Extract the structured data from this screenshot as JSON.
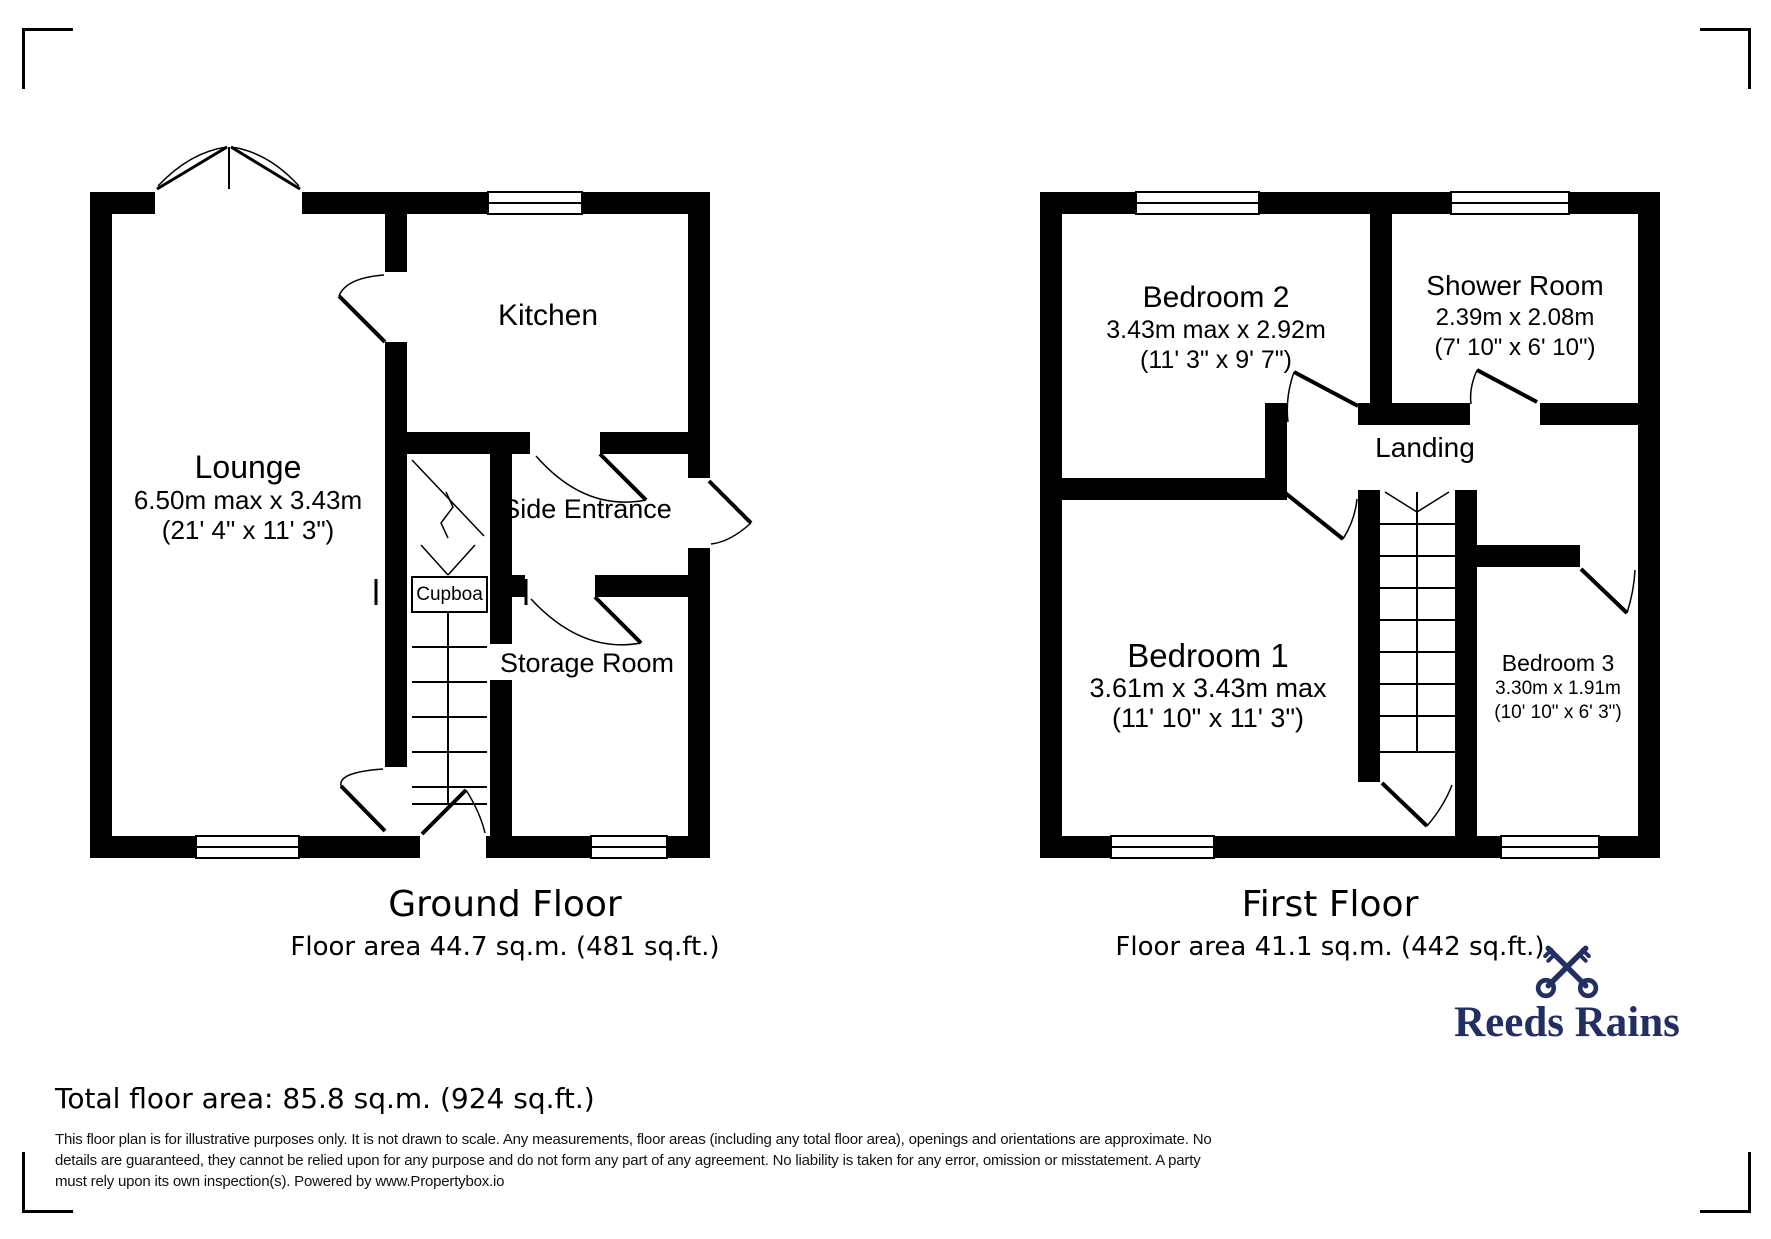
{
  "branding": {
    "logo_text": "Reeds Rains",
    "logo_color": "#212f63"
  },
  "ground_floor": {
    "title": "Ground Floor",
    "floor_area": "Floor area 44.7 sq.m. (481 sq.ft.)",
    "rooms": {
      "lounge": {
        "name": "Lounge",
        "dim_metric": "6.50m max x 3.43m",
        "dim_imperial": "(21' 4\" x 11' 3\")"
      },
      "kitchen": {
        "name": "Kitchen"
      },
      "side_entrance": {
        "name": "Side Entrance"
      },
      "storage_room": {
        "name": "Storage Room"
      },
      "cupboard": {
        "name": "Cupboa"
      }
    }
  },
  "first_floor": {
    "title": "First Floor",
    "floor_area": "Floor area 41.1 sq.m. (442 sq.ft.)",
    "rooms": {
      "bedroom_1": {
        "name": "Bedroom 1",
        "dim_metric": "3.61m x 3.43m max",
        "dim_imperial": "(11' 10\" x 11' 3\")"
      },
      "bedroom_2": {
        "name": "Bedroom 2",
        "dim_metric": "3.43m max x 2.92m",
        "dim_imperial": "(11' 3\" x 9' 7\")"
      },
      "bedroom_3": {
        "name": "Bedroom 3",
        "dim_metric": "3.30m x 1.91m",
        "dim_imperial": "(10' 10\" x 6' 3\")"
      },
      "shower_room": {
        "name": "Shower Room",
        "dim_metric": "2.39m x 2.08m",
        "dim_imperial": "(7' 10\" x 6' 10\")"
      },
      "landing": {
        "name": "Landing"
      }
    }
  },
  "footer": {
    "total_area": "Total floor area: 85.8 sq.m. (924 sq.ft.)",
    "disclaimer_lines": [
      "This floor plan is for illustrative purposes only. It is not drawn to scale. Any measurements, floor areas (including any total floor area), openings and orientations are approximate. No",
      "details are guaranteed, they cannot be relied upon for any purpose and do not form any part of any agreement. No liability is taken for any error, omission or misstatement. A party",
      "must rely upon its own inspection(s). Powered by www.Propertybox.io"
    ]
  }
}
